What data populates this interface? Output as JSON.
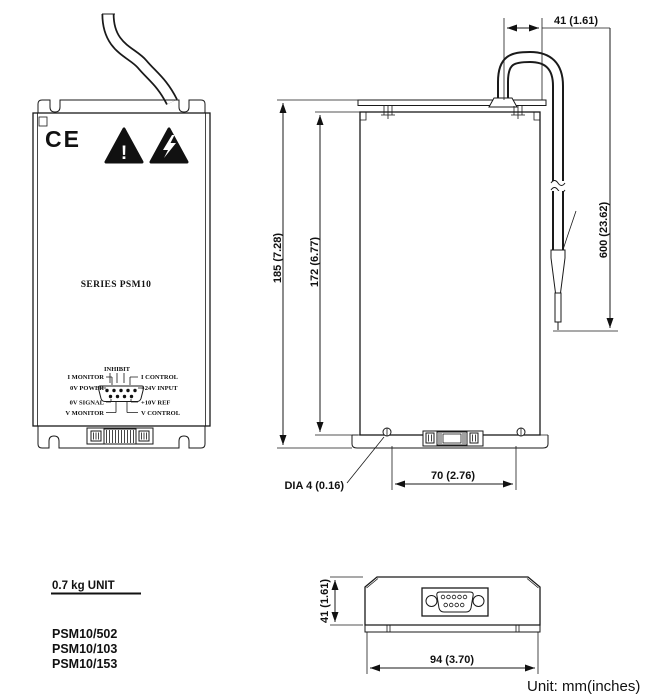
{
  "front_view": {
    "ce_mark": "CE",
    "caution_symbol": "!",
    "series_label": "SERIES PSM10",
    "pinout": {
      "top": "INHIBIT",
      "left": [
        "I MONITOR",
        "0V POWER",
        "0V SIGNAL",
        "V MONITOR"
      ],
      "right": [
        "I CONTROL",
        "+24V INPUT",
        "+10V REF",
        "V CONTROL"
      ]
    }
  },
  "side_view": {
    "dim_height_outer": "185 (7.28)",
    "dim_height_inner": "172 (6.77)",
    "dim_cable_offset": "41 (1.61)",
    "dim_cable_length": "600 (23.62)",
    "dim_hole_dia": "DIA 4 (0.16)",
    "dim_hole_pitch": "70 (2.76)"
  },
  "bottom_view": {
    "dim_depth": "41 (1.61)",
    "dim_width": "94 (3.70)"
  },
  "notes": {
    "weight": "0.7 kg UNIT",
    "models": [
      "PSM10/502",
      "PSM10/103",
      "PSM10/153"
    ],
    "unit_note": "Unit: mm(inches)"
  }
}
